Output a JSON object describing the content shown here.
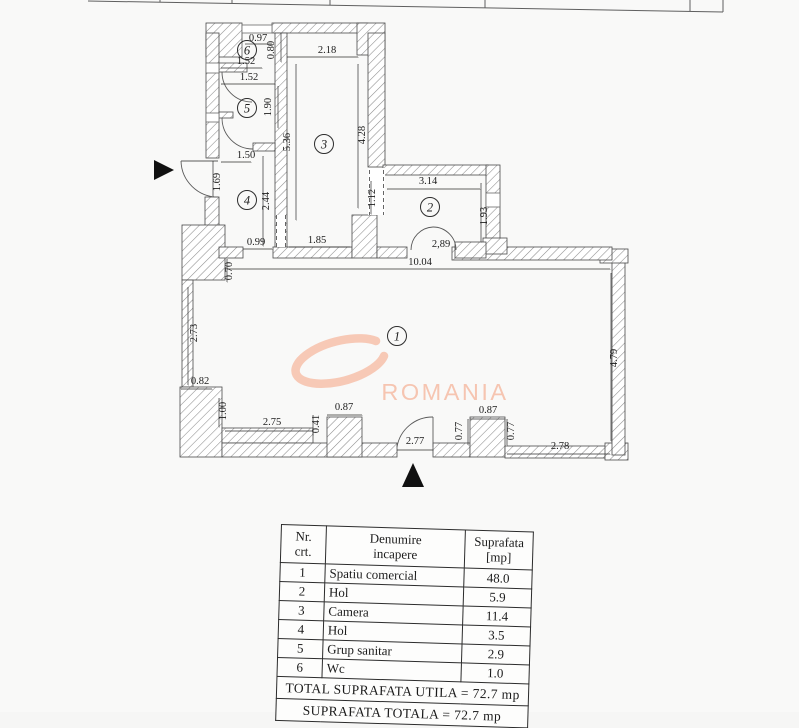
{
  "page": {
    "background": "#f9f9f8"
  },
  "floorplan": {
    "watermark": {
      "text": "ROMANIA",
      "text_color": "#f6c5b1",
      "swoosh_color": "#f7c9b6"
    },
    "room_markers": [
      {
        "n": "1",
        "x": 397,
        "y": 336
      },
      {
        "n": "2",
        "x": 430,
        "y": 207
      },
      {
        "n": "3",
        "x": 324,
        "y": 144
      },
      {
        "n": "4",
        "x": 247,
        "y": 200
      },
      {
        "n": "5",
        "x": 247,
        "y": 108
      },
      {
        "n": "6",
        "x": 247,
        "y": 50
      }
    ],
    "dimension_labels": [
      {
        "t": "0.97",
        "x": 258,
        "y": 41,
        "rot": 0
      },
      {
        "t": "2.18",
        "x": 327,
        "y": 53,
        "rot": 0
      },
      {
        "t": "0.80",
        "x": 274,
        "y": 50,
        "rot": -90
      },
      {
        "t": "1.52",
        "x": 246,
        "y": 64,
        "rot": 0
      },
      {
        "t": "1.52",
        "x": 249,
        "y": 80,
        "rot": 0
      },
      {
        "t": "1.90",
        "x": 271,
        "y": 107,
        "rot": -90
      },
      {
        "t": "5.36",
        "x": 290,
        "y": 142,
        "rot": -90
      },
      {
        "t": "4.28",
        "x": 365,
        "y": 135,
        "rot": -90
      },
      {
        "t": "1.50",
        "x": 246,
        "y": 158,
        "rot": 0
      },
      {
        "t": "1.69",
        "x": 220,
        "y": 182,
        "rot": -90
      },
      {
        "t": "2.44",
        "x": 269,
        "y": 201,
        "rot": -90
      },
      {
        "t": "3.14",
        "x": 428,
        "y": 184,
        "rot": 0
      },
      {
        "t": "1.12",
        "x": 375,
        "y": 198,
        "rot": -90
      },
      {
        "t": "1.93",
        "x": 487,
        "y": 216,
        "rot": -90
      },
      {
        "t": "0.99",
        "x": 256,
        "y": 245,
        "rot": 0
      },
      {
        "t": "1.85",
        "x": 317,
        "y": 243,
        "rot": 0
      },
      {
        "t": "2,89",
        "x": 441,
        "y": 247,
        "rot": 0
      },
      {
        "t": "10.04",
        "x": 420,
        "y": 265,
        "rot": 0
      },
      {
        "t": "0.70",
        "x": 232,
        "y": 271,
        "rot": -90
      },
      {
        "t": "2.73",
        "x": 197,
        "y": 333,
        "rot": -90
      },
      {
        "t": "4.79",
        "x": 617,
        "y": 358,
        "rot": -90
      },
      {
        "t": "0.82",
        "x": 200,
        "y": 384,
        "rot": 0
      },
      {
        "t": "1.00",
        "x": 226,
        "y": 411,
        "rot": -90
      },
      {
        "t": "2.75",
        "x": 272,
        "y": 425,
        "rot": 0
      },
      {
        "t": "0.41",
        "x": 319,
        "y": 424,
        "rot": -90
      },
      {
        "t": "0.87",
        "x": 344,
        "y": 410,
        "rot": 0
      },
      {
        "t": "2.77",
        "x": 415,
        "y": 444,
        "rot": 0
      },
      {
        "t": "0.77",
        "x": 462,
        "y": 431,
        "rot": -90
      },
      {
        "t": "0.77",
        "x": 514,
        "y": 431,
        "rot": -90
      },
      {
        "t": "0.87",
        "x": 488,
        "y": 413,
        "rot": 0
      },
      {
        "t": "2.78",
        "x": 560,
        "y": 449,
        "rot": 0
      }
    ]
  },
  "area_table": {
    "headers": {
      "nr": "Nr.\ncrt.",
      "name": "Denumire\nincapere",
      "area": "Suprafata\n[mp]"
    },
    "rows": [
      {
        "nr": "1",
        "name": "Spatiu comercial",
        "area": "48.0"
      },
      {
        "nr": "2",
        "name": "Hol",
        "area": "5.9"
      },
      {
        "nr": "3",
        "name": "Camera",
        "area": "11.4"
      },
      {
        "nr": "4",
        "name": "Hol",
        "area": "3.5"
      },
      {
        "nr": "5",
        "name": "Grup sanitar",
        "area": "2.9"
      },
      {
        "nr": "6",
        "name": "Wc",
        "area": "1.0"
      }
    ],
    "total_utila": "TOTAL SUPRAFATA UTILA = 72.7 mp",
    "total_totala": "SUPRAFATA TOTALA = 72.7 mp"
  }
}
